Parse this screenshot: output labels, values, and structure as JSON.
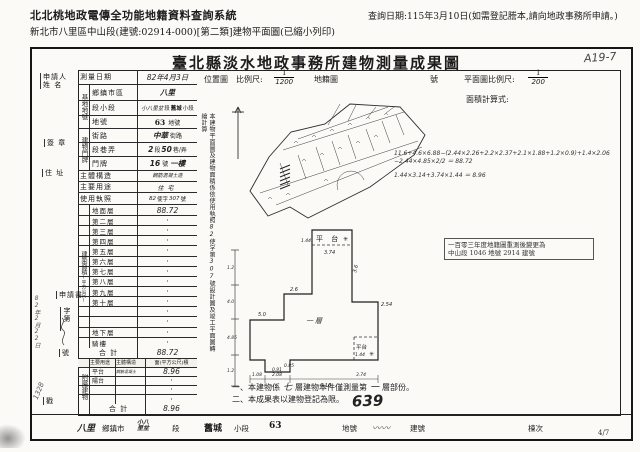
{
  "colors": {
    "paper": "#fbfaf7",
    "ink": "#1c1c1c"
  },
  "header": {
    "system_title": "北北桃地政電傳全功能地籍資料查詢系統",
    "subtitle": "新北市八里區中山段(建號:02914-000)[第二類]建物平面圖(已縮小列印)",
    "query_date": "查詢日期:115年3月10日(如需登記謄本,請向地政事務所申請。)"
  },
  "document": {
    "title": "臺北縣淡水地政事務所建物測量成果圖",
    "page_mark": "A19-7",
    "page_number": "4/7",
    "stamp_639": "639"
  },
  "form": {
    "margin": {
      "applicant": "申請人",
      "applicant2": "姓 名",
      "seal": "簽 章",
      "address": "住 址",
      "application": "申請書",
      "zi": "字第",
      "no": "號",
      "chop": "戳",
      "note1": "82年2月22日",
      "note2": "1328"
    },
    "survey": {
      "label": "測量日期",
      "value": "82年4月3日"
    },
    "land": {
      "group": "基地地號",
      "r1": {
        "label": "鄉鎮市區",
        "hw": "八里"
      },
      "r2": {
        "label": "段小段",
        "hw": "小八里坌",
        "p1": "段",
        "stamp": "舊城",
        "p2": "小段"
      },
      "r3": {
        "label": "地號",
        "stamp": "63",
        "p1": "地號"
      }
    },
    "door": {
      "group": "建物門牌",
      "r1": {
        "label": "街路",
        "hw": "中華",
        "p1": "街路"
      },
      "r2": {
        "label": "段巷弄",
        "hw1": "2",
        "p1": "段",
        "hw2": "50",
        "p2": "巷/弄"
      },
      "r3": {
        "label": "門牌",
        "hw1": "16",
        "p1": "號",
        "hw2": "一樓"
      }
    },
    "structure": {
      "label": "主體構造",
      "value": "鋼筋混凝土造"
    },
    "usage": {
      "label": "主要用途",
      "value": "住宅"
    },
    "license": {
      "label": "使用執照",
      "hw1": "82",
      "p1": "使字",
      "hw2": "307",
      "p2": "號"
    },
    "area": {
      "group": "建築面積",
      "unit": "(平方公尺)",
      "rows": [
        {
          "label": "地面層",
          "value": "88.72",
          "hw": true
        },
        {
          "label": "第二層",
          "value": "·"
        },
        {
          "label": "第三層",
          "value": "·"
        },
        {
          "label": "第四層",
          "value": "·"
        },
        {
          "label": "第五層",
          "value": "·"
        },
        {
          "label": "第六層",
          "value": "·"
        },
        {
          "label": "第七層",
          "value": "·"
        },
        {
          "label": "第八層",
          "value": "·"
        },
        {
          "label": "第九層",
          "value": "·"
        },
        {
          "label": "第十層",
          "value": "·"
        },
        {
          "label": "",
          "value": "·"
        },
        {
          "label": "",
          "value": "·"
        },
        {
          "label": "地下層",
          "value": "·"
        },
        {
          "label": "騎樓",
          "value": "·"
        }
      ],
      "total_label": "合 計",
      "total_value": "88.72"
    },
    "annex": {
      "group": "附屬建物",
      "headers": [
        "主要用途",
        "主體構造",
        "面(平方公尺)積"
      ],
      "rows": [
        {
          "use": "平台",
          "structure": "鋼筋混凝土",
          "area": "8.96",
          "hw": true
        },
        {
          "use": "陽台",
          "structure": "",
          "area": "·"
        },
        {
          "use": "",
          "structure": "",
          "area": "·"
        },
        {
          "use": "",
          "structure": "",
          "area": "·"
        }
      ],
      "total_label": "合 計",
      "total_value": "8.96"
    },
    "side_note": {
      "p1": "本建物平面圖及建物面積係依使用執照",
      "hw1": "82",
      "p2": "使字第",
      "hw2": "307",
      "p3": "號設計圖及竣工平面圖轉繪計算"
    }
  },
  "right_panel": {
    "location_label": "位置圖",
    "scale_label": "比例尺:",
    "scale_num": "1",
    "scale_den": "1200",
    "cadastre_label": "地籍圖",
    "cadastre_no_label": "號",
    "plan_scale_label": "平面圖比例尺:",
    "plan_scale_num": "1",
    "plan_scale_den": "200",
    "calc_label": "面積計算式:",
    "calc_lines": [
      "11.6+4.6×6.88−(2.44×2.26+2.2×2.37+2.1×1.88+1.2×0.9)+1.4×2.06",
      "−2.44×4.85×2/2 ＝ 88.72",
      "1.44×3.14+3.74×1.44 ＝ 8.96"
    ],
    "resurvey_stamp_l1": "一百零三年度地籍圖重測後變更為",
    "resurvey_stamp_l2": "中山段 1046 地號 2914 建號",
    "plan": {
      "plat_top": "平 台",
      "plat_top_dim": "1.44",
      "top_dim": "3.74",
      "star": "✳",
      "right_up": "3.6",
      "right": "2.54",
      "left_up": "2.6",
      "left": "5.0",
      "floor": "一層",
      "plat_bot": "平台",
      "plat_bot_dim": "1.44",
      "b1": "1.08",
      "b2": "2.08",
      "b3": "6.16",
      "b4": "3.74",
      "n1": "0.85",
      "n2": "0.91",
      "left_ticks": [
        "1.2",
        "4.0",
        "4.85",
        "1.2"
      ]
    },
    "notes": {
      "n1a": "一、本建物係",
      "n1hw1": "七",
      "n1b": "層建物本件僅測量第",
      "n1hw2": "一",
      "n1c": "層部份。",
      "n2": "二、本成果表以建物登記為限。"
    }
  },
  "bottom_bar": {
    "items": [
      {
        "value": "八里",
        "label": "鄉鎮市",
        "style": "hw"
      },
      {
        "value": "小八里坌",
        "label": "段",
        "style": "two"
      },
      {
        "value": "舊城",
        "label": "小段",
        "style": "stamp"
      },
      {
        "value": "63",
        "label": "地號",
        "style": "stamp"
      },
      {
        "value": "〰〰",
        "label": "建號",
        "style": "scribble"
      },
      {
        "value": "",
        "label": "棟次",
        "style": ""
      }
    ]
  }
}
